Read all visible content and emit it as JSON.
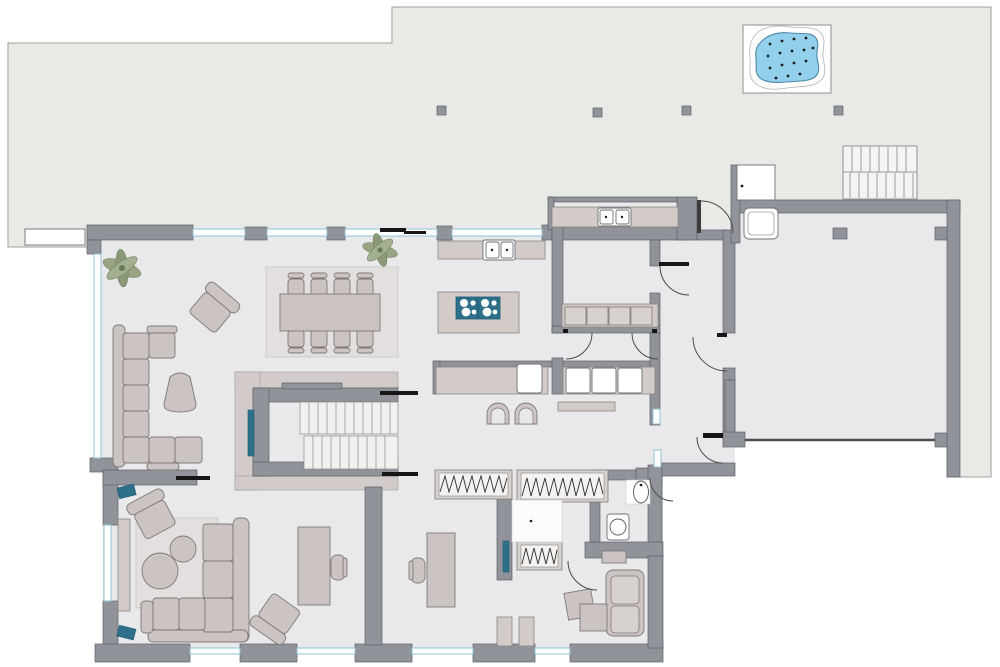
{
  "palette": {
    "page_bg": "#ffffff",
    "terrace_fill": "#e8eae5",
    "terrace_stroke": "#9da09b",
    "floor_fill": "#e9e9ec",
    "wall_fill": "#90939a",
    "wall_stroke": "#5d6066",
    "glass_fill": "#ffffff",
    "glass_stroke": "#8fc3d6",
    "furniture_fill": "#cbc4c3",
    "furniture_light": "#d8d2cf",
    "furniture_stroke": "#7e7977",
    "counter_fill": "#d2cbc8",
    "rug_fill": "#e2dfde",
    "landing_fill": "#d2cbc9",
    "step_fill": "#f2f1f0",
    "appliance_fill": "#ffffff",
    "appliance_stroke": "#6f7173",
    "accent_teal": "#2e7089",
    "teal_dark": "#1d5a73",
    "hot_tub_blue": "#93d0ec",
    "hot_tub_stroke": "#4f88a4",
    "plant_green": "#97a584",
    "plant_dark": "#6b7a58",
    "door_black": "#161616",
    "arc_stroke": "#4a4a4a"
  },
  "inventory": {
    "objects": [
      "terrace",
      "roof-posts",
      "hot-tub",
      "firewood-rack",
      "doormat",
      "living-sofa",
      "armchairs",
      "pouf",
      "plants",
      "dining-rug",
      "dining-table",
      "dining-chairs",
      "kitchen-counter",
      "kitchen-sink",
      "kitchen-island",
      "cooktop",
      "bar-stools",
      "scullery-counter",
      "scullery-sink",
      "pantry-cabinets",
      "utility-appliances",
      "staircase",
      "wardrobes",
      "dressing-room",
      "toilet",
      "washbasin",
      "bedroom-sofa",
      "side-tables",
      "wall-shelf",
      "desks",
      "desk-chairs",
      "sideboard",
      "speakers",
      "coffee-tables",
      "garage",
      "garage-door",
      "entry-door"
    ],
    "counts": {
      "dining_chairs": 8,
      "roof_posts": 4,
      "cooktop_burners": 8,
      "utility_appliances": 3,
      "bar_stools": 2,
      "hot_tub_jets": 16,
      "stair_flights": 2
    }
  }
}
